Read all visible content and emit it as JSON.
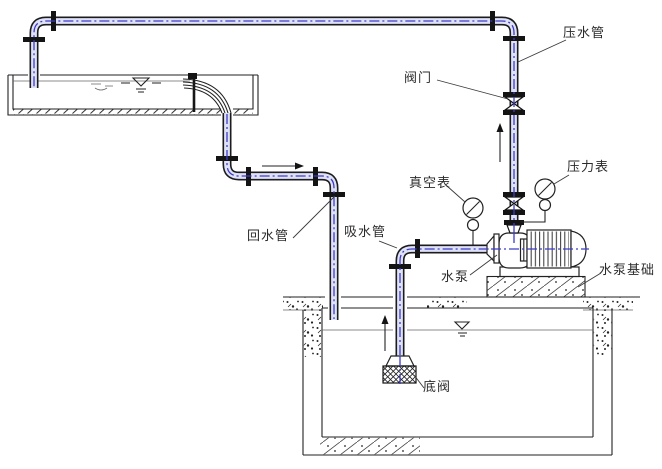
{
  "diagram": {
    "labels": {
      "pressure_pipe": "压水管",
      "valve": "阀门",
      "vacuum_gauge": "真空表",
      "pressure_gauge": "压力表",
      "return_pipe": "回水管",
      "suction_pipe": "吸水管",
      "pump": "水泵",
      "pump_foundation": "水泵基础",
      "foot_valve": "底阀"
    },
    "colors": {
      "centerline": "#3c3cc8",
      "pipe_fill": "#dfe1f6",
      "line": "#222222",
      "background": "#ffffff"
    }
  }
}
